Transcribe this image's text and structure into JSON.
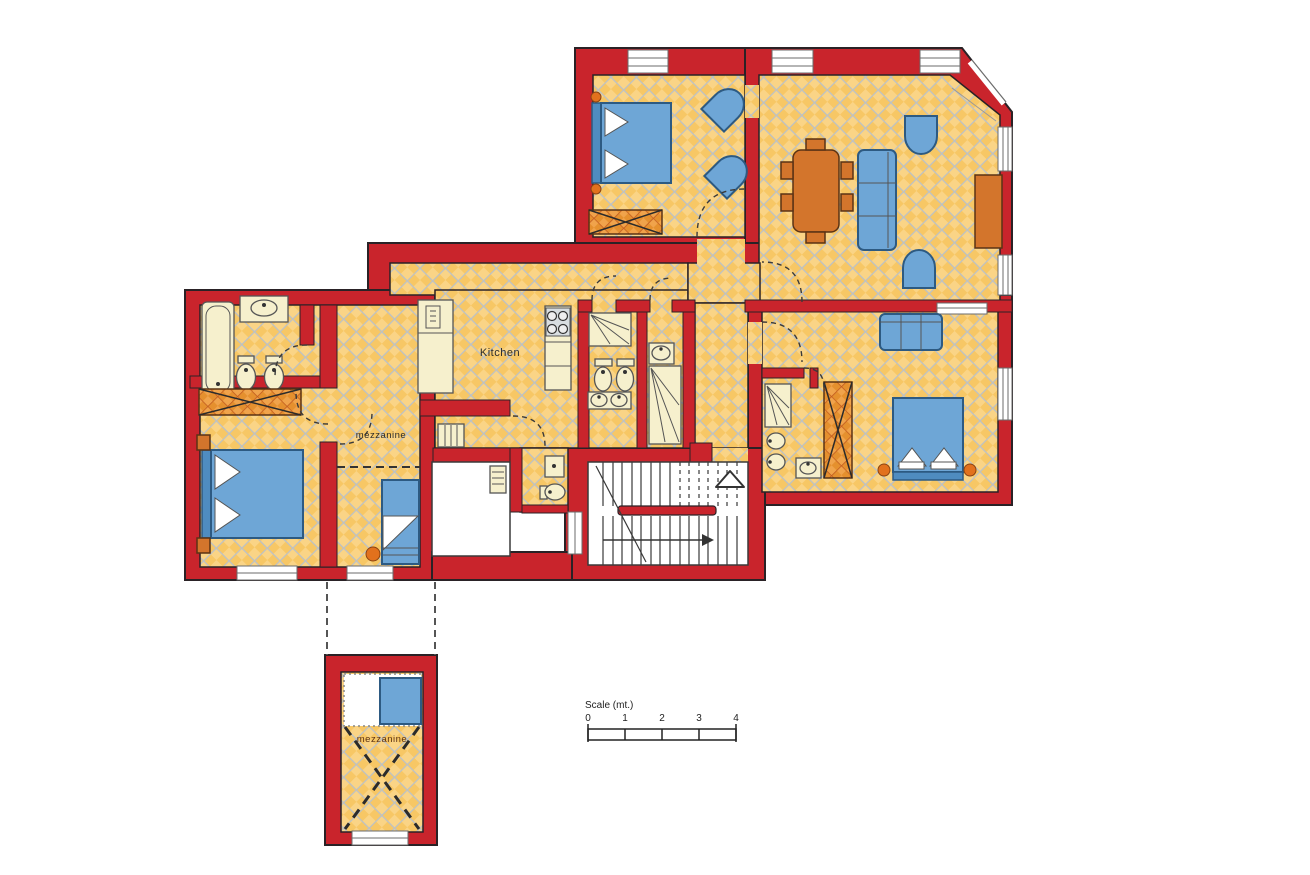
{
  "title": "Apartment floor plan",
  "labels": {
    "kitchen": "Kitchen",
    "mezzanine_room": "mezzanine",
    "mezzanine_annex": "mezzanine"
  },
  "scale_bar": {
    "title": "Scale  (mt.)",
    "ticks": [
      "0",
      "1",
      "2",
      "3",
      "4"
    ]
  },
  "colors": {
    "wall_red": "#c9242c",
    "floor_yellow": "#f7c765",
    "floor_yellow_light": "#fad486",
    "floor_grid_gray": "#bac1c8",
    "furniture_blue": "#6ea6d6",
    "furniture_orange": "#d3752c",
    "fixture_cream": "#f6f0cd",
    "background": "#ffffff"
  }
}
